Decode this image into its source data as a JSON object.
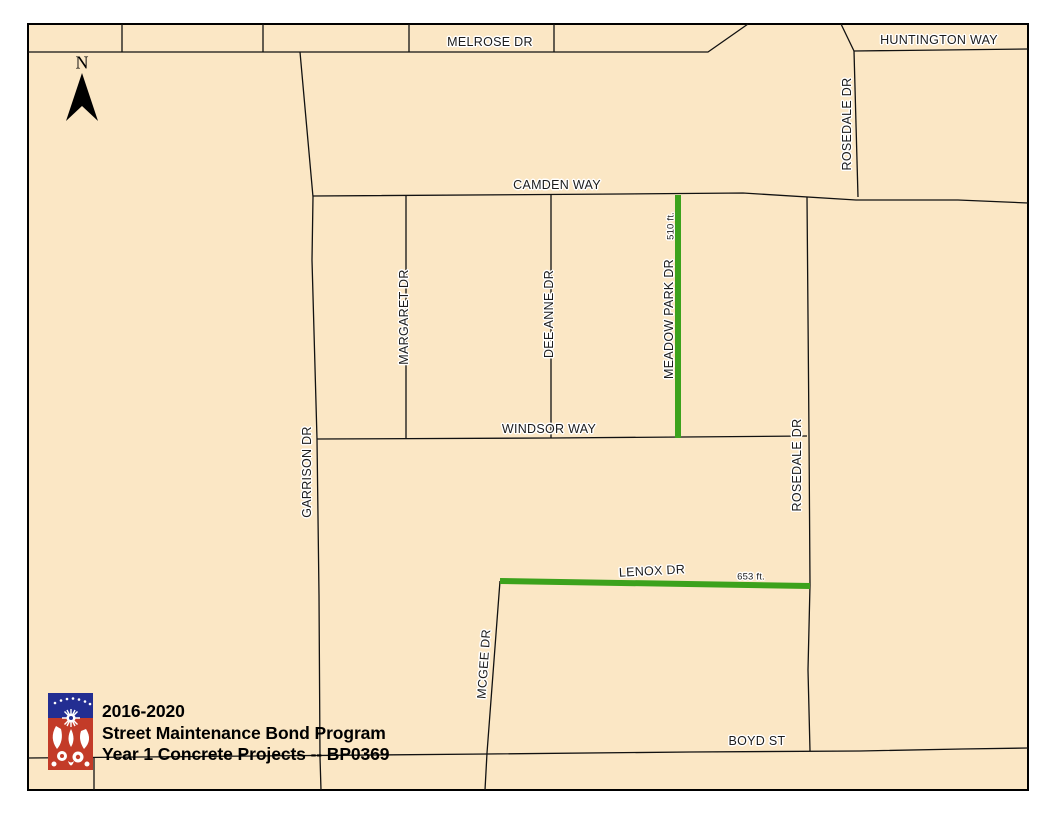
{
  "map_title": {
    "line1": "2016-2020",
    "line2": "Street Maintenance Bond Program",
    "line3": "Year 1 Concrete Projects -- BP0369"
  },
  "north_indicator": {
    "label": "N"
  },
  "street_labels": {
    "melrose": "MELROSE DR",
    "huntington": "HUNTINGTON WAY",
    "rosedale_upper": "ROSEDALE DR",
    "camden": "CAMDEN WAY",
    "margaret": "MARGARET DR",
    "dee_anne": "DEE ANNE DR",
    "meadow_park": "MEADOW PARK DR",
    "windsor": "WINDSOR WAY",
    "garrison": "GARRISON DR",
    "rosedale_lower": "ROSEDALE DR",
    "lenox": "LENOX DR",
    "mcgee": "MCGEE DR",
    "boyd": "BOYD ST"
  },
  "projects": [
    {
      "street": "MEADOW PARK DR",
      "length_label": "510 ft."
    },
    {
      "street": "LENOX DR",
      "length_label": "653 ft."
    }
  ],
  "colors": {
    "map_background": "#FBE7C5",
    "street_line": "#111111",
    "project_highlight": "#3CA21C",
    "logo_blue": "#232E92",
    "logo_red": "#C33B28"
  }
}
